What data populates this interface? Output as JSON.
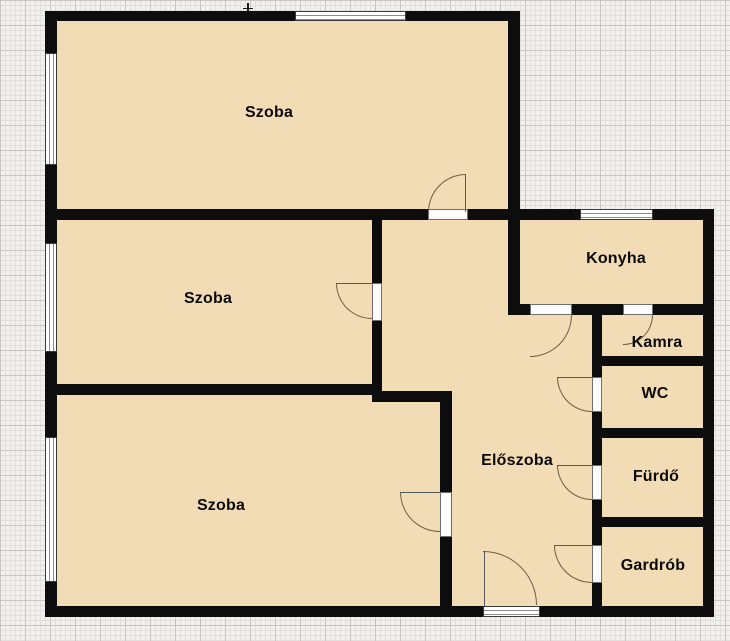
{
  "plan": {
    "rooms": {
      "szoba_top": {
        "label": "Szoba"
      },
      "szoba_middle": {
        "label": "Szoba"
      },
      "szoba_bottom": {
        "label": "Szoba"
      },
      "konyha": {
        "label": "Konyha"
      },
      "kamra": {
        "label": "Kamra"
      },
      "wc": {
        "label": "WC"
      },
      "furdo": {
        "label": "Fürdő"
      },
      "gardrob": {
        "label": "Gardrób"
      },
      "eloszoba": {
        "label": "Előszoba"
      }
    },
    "colors": {
      "room_fill": "#f2dcb6",
      "wall": "#0d0d0d",
      "paper_background": "#f1f0ed",
      "grid_minor": "#e2e0dc",
      "grid_major": "#c9c6c2",
      "door_arc": "#6b5d45",
      "window_fill": "#ffffff"
    }
  }
}
